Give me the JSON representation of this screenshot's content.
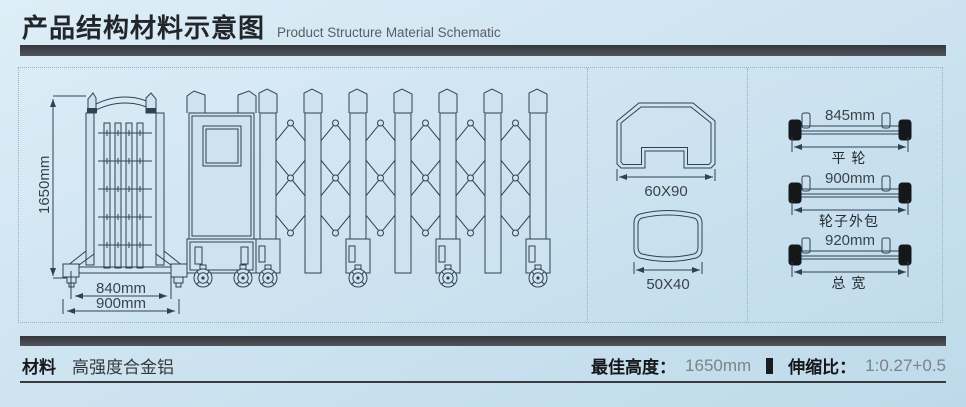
{
  "colors": {
    "background_top": "#ddeef7",
    "background_bottom": "#bedaea",
    "line": "#2f4254",
    "dark_bar": "#34383d",
    "dashed_border": "#92b2c6"
  },
  "header": {
    "title_zh": "产品结构材料示意图",
    "title_en": "Product Structure Material Schematic"
  },
  "diagram": {
    "gate_front": {
      "height": "1650mm",
      "inner_width": "840mm",
      "outer_width": "900mm"
    },
    "profiles": [
      {
        "label": "60X90"
      },
      {
        "label": "50X40"
      }
    ],
    "axles": [
      {
        "size": "845mm",
        "name": "平 轮"
      },
      {
        "size": "900mm",
        "name": "轮子外包"
      },
      {
        "size": "920mm",
        "name": "总 宽"
      }
    ]
  },
  "footer": {
    "material_label": "材料",
    "material_value": "高强度合金铝",
    "best_height_label": "最佳高度：",
    "best_height_value": "1650mm",
    "ratio_label": "伸缩比：",
    "ratio_value": "1:0.27+0.5"
  }
}
